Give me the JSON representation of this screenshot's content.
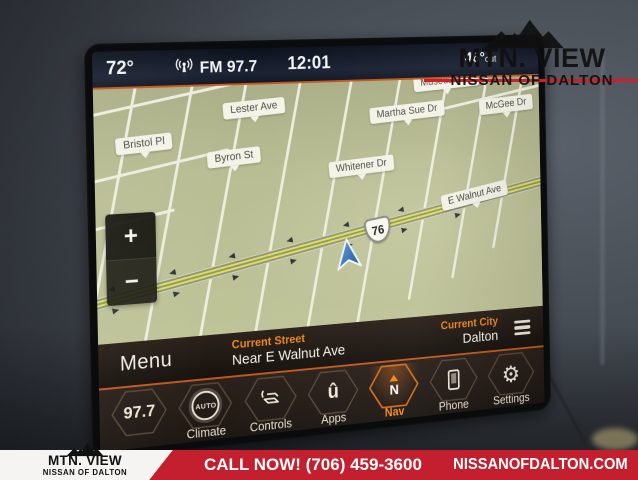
{
  "dealer": {
    "name": "MTN. VIEW",
    "subname": "NISSAN OF DALTON",
    "banner_call": "CALL NOW! (706) 459-3600",
    "banner_site": "NISSANOFDALTON.COM",
    "banner_red": "#c41f2e"
  },
  "screen": {
    "status_bar": {
      "inside_temp": "72°",
      "source": "FM 97.7",
      "clock": "12:01",
      "outside_temp": "46°",
      "outside_suffix": "out"
    },
    "map": {
      "streets": {
        "musedale": "Musedale Dr",
        "lester": "Lester Ave",
        "martha_sue": "Martha Sue Dr",
        "mcgee": "McGee Dr",
        "bristol": "Bristol Pl",
        "byron": "Byron St",
        "whitener": "Whitener Dr",
        "e_walnut": "E Walnut Ave"
      },
      "route_shield": "76",
      "zoom_in": "+",
      "zoom_out": "−"
    },
    "info_bar": {
      "menu": "Menu",
      "current_street_label": "Current Street",
      "current_street": "Near E Walnut Ave",
      "current_city_label": "Current City",
      "current_city": "Dalton"
    },
    "taskbar": {
      "items": [
        {
          "station": "97.7",
          "icon": "radio-station"
        },
        {
          "label": "Climate",
          "icon": "auto-climate",
          "icon_text": "AUTO"
        },
        {
          "label": "Controls",
          "icon": "seat-controls"
        },
        {
          "label": "Apps",
          "icon": "uconnect-app",
          "icon_text": "û"
        },
        {
          "label": "Nav",
          "icon": "compass-north",
          "icon_text": "N",
          "active": true
        },
        {
          "label": "Phone",
          "icon": "phone"
        },
        {
          "label": "Settings",
          "icon": "gear"
        }
      ]
    },
    "colors": {
      "accent_orange": "#ee8722",
      "map_green": "#b9bd93",
      "nav_blue": "#2f6fb4",
      "alert_red": "#cf1f2d"
    }
  }
}
